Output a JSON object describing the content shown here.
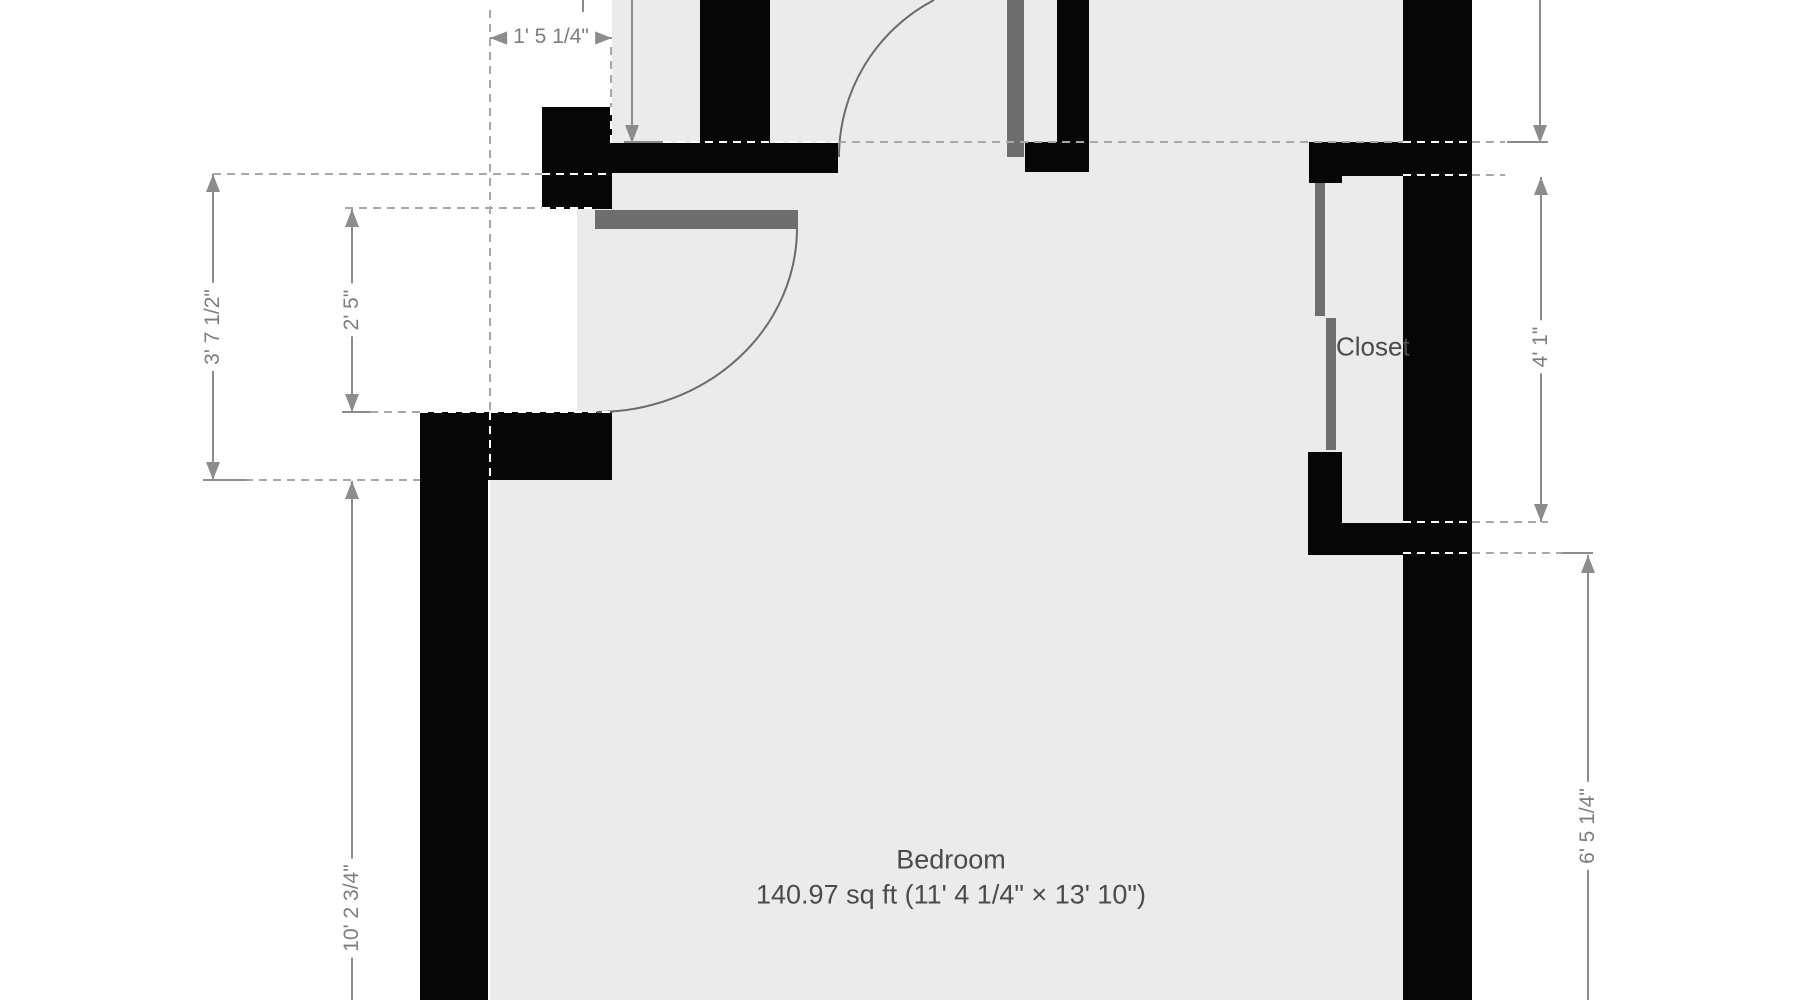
{
  "rooms": {
    "bedroom": {
      "name": "Bedroom",
      "area": "140.97 sq ft (11' 4 1/4\" × 13' 10\")"
    },
    "closet": {
      "name": "Closet"
    }
  },
  "dimensions": {
    "top_offset": "1' 5 1/4\"",
    "left_outer": "3' 7 1/2\"",
    "left_opening": "2' 5\"",
    "left_lower": "10' 2 3/4\"",
    "closet_height": "4' 1\"",
    "right_lower": "6' 5 1/4\""
  },
  "colors": {
    "wall": "#060606",
    "floor": "#ebebeb",
    "outside": "#ffffff",
    "door_leaf": "#6e6e6e",
    "dimension_line": "#8c8c8c",
    "dashed_line": "#a8a8a8",
    "dimension_text": "#7d7d7d",
    "label_text": "#4b4b4b"
  }
}
